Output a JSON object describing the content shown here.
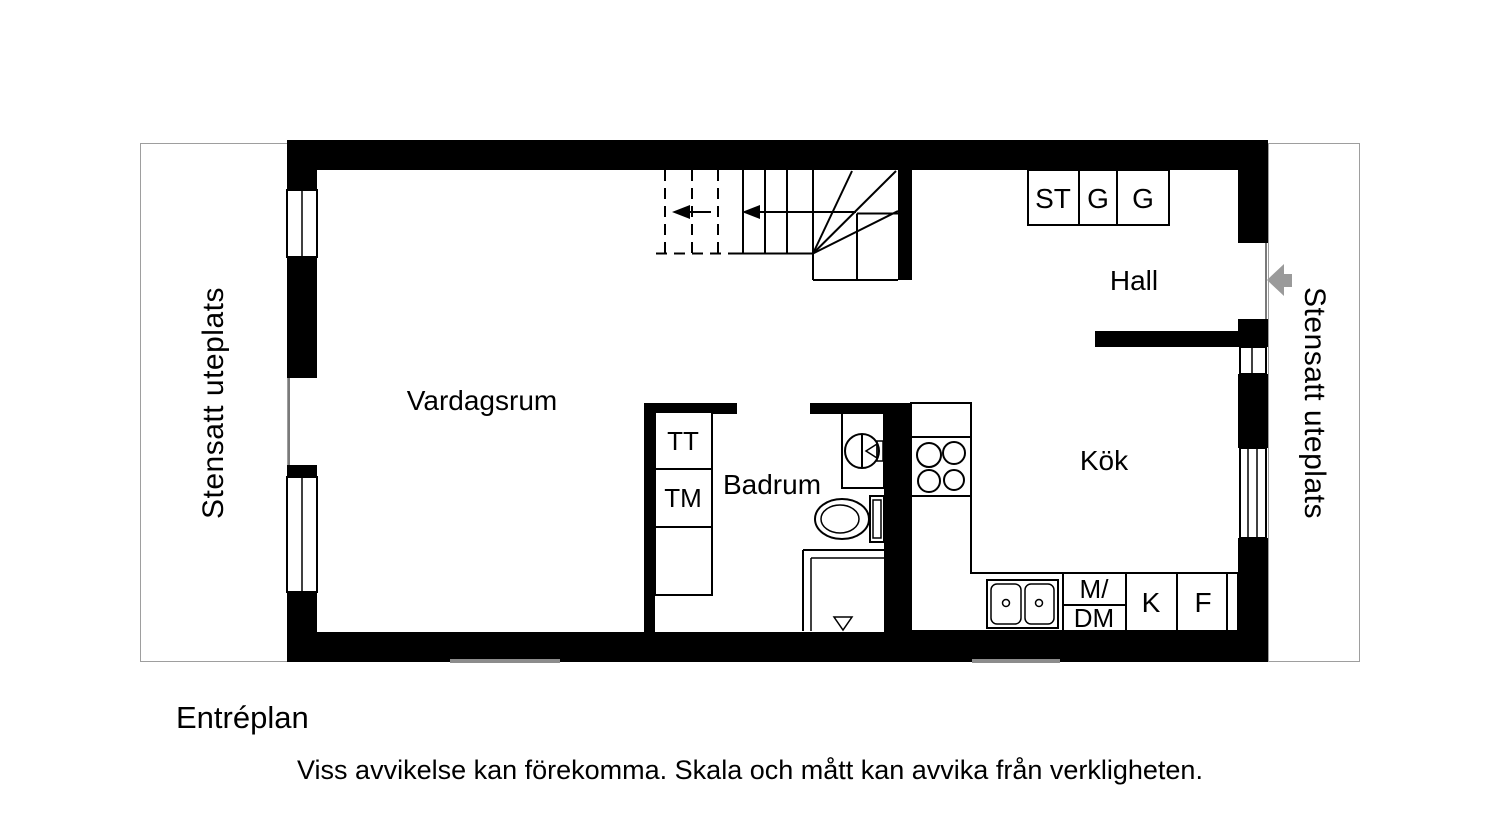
{
  "title": "Entréplan",
  "disclaimer": "Viss avvikelse kan förekomma. Skala och mått kan avvika från verkligheten.",
  "patio_left": {
    "label": "Stensatt uteplats"
  },
  "patio_right": {
    "label": "Stensatt uteplats"
  },
  "rooms": {
    "living_room": "Vardagsrum",
    "hall": "Hall",
    "kitchen": "Kök",
    "bathroom": "Badrum"
  },
  "closets": {
    "st": "ST",
    "g1": "G",
    "g2": "G"
  },
  "laundry": {
    "dryer": "TT",
    "washer": "TM"
  },
  "kitchen_units": {
    "micro": "M/",
    "dishwasher": "DM",
    "fridge": "K",
    "freezer": "F"
  },
  "colors": {
    "wall": "#000000",
    "line": "#000000",
    "entry_arrow": "#9a9a9a",
    "patio_border": "#9e9e9e",
    "step_gray": "#8c8c8c"
  }
}
